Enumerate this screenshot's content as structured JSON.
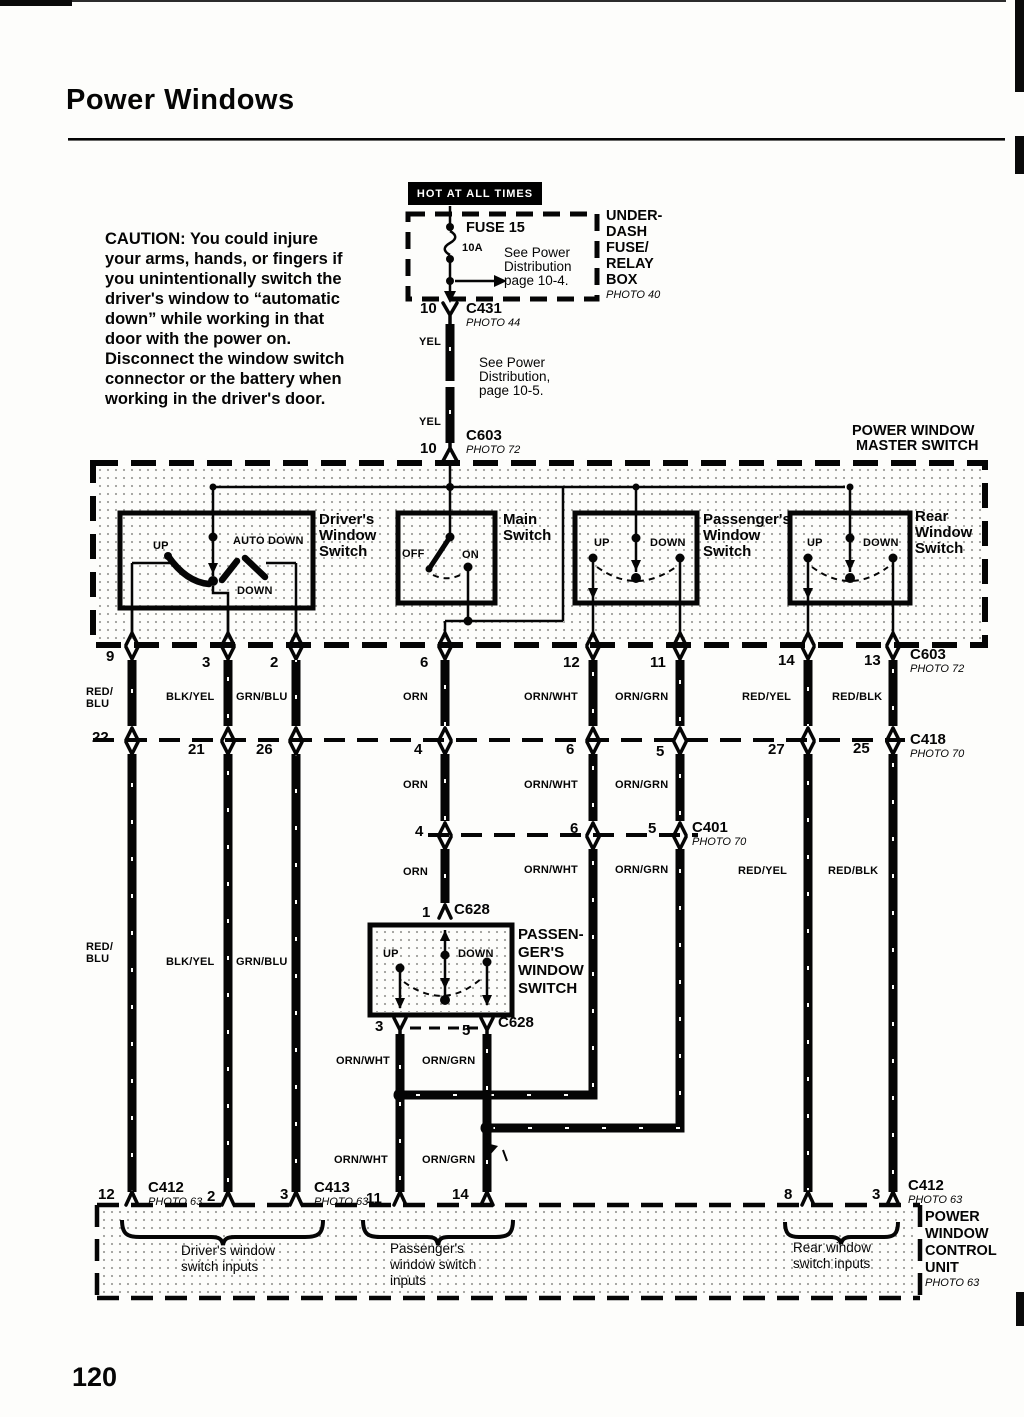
{
  "page": {
    "title": "Power Windows",
    "number": "120"
  },
  "caution": {
    "lines": [
      "CAUTION: You could injure",
      "your arms, hands, or fingers if",
      "you unintentionally switch the",
      "driver's window to “automatic",
      "down” while working in that",
      "door with the power on.",
      "Disconnect the window switch",
      "connector or the battery when",
      "working in the driver's door."
    ]
  },
  "fusebox": {
    "hot": "HOT AT ALL TIMES",
    "fuse": "FUSE 15",
    "amps": "10A",
    "note": [
      "See Power",
      "Distribution",
      "page 10-4."
    ],
    "box_name": [
      "UNDER-",
      "DASH",
      "FUSE/",
      "RELAY",
      "BOX"
    ],
    "photo": "PHOTO 40"
  },
  "feed": {
    "c431_pin": "10",
    "c431": "C431",
    "c431_photo": "PHOTO 44",
    "yel1": "YEL",
    "note": [
      "See Power",
      "Distribution,",
      "page 10-5."
    ],
    "yel2": "YEL",
    "c603_pin": "10",
    "c603": "C603",
    "c603_photo": "PHOTO 72"
  },
  "master": {
    "title": [
      "POWER WINDOW",
      "MASTER SWITCH"
    ],
    "driver": {
      "name": [
        "Driver's",
        "Window",
        "Switch"
      ],
      "up": "UP",
      "auto_down": "AUTO DOWN",
      "down": "DOWN"
    },
    "main": {
      "name": [
        "Main",
        "Switch"
      ],
      "off": "OFF",
      "on": "ON"
    },
    "passenger": {
      "name": [
        "Passenger's",
        "Window",
        "Switch"
      ],
      "up": "UP",
      "down": "DOWN"
    },
    "rear": {
      "name": [
        "Rear",
        "Window",
        "Switch"
      ],
      "up": "UP",
      "down": "DOWN"
    }
  },
  "c603_row": {
    "name": "C603",
    "photo": "PHOTO 72",
    "pins": [
      "9",
      "3",
      "2",
      "6",
      "12",
      "11",
      "14",
      "13"
    ],
    "colors": [
      "RED/\nBLU",
      "BLK/YEL",
      "GRN/BLU",
      "ORN",
      "ORN/WHT",
      "ORN/GRN",
      "RED/YEL",
      "RED/BLK"
    ]
  },
  "c418_row": {
    "name": "C418",
    "photo": "PHOTO 70",
    "pins": [
      "22",
      "21",
      "26",
      "4",
      "6",
      "5",
      "27",
      "25"
    ]
  },
  "mid_colors": [
    "ORN",
    "ORN/WHT",
    "ORN/GRN"
  ],
  "c401_row": {
    "name": "C401",
    "photo": "PHOTO 70",
    "pins": [
      "4",
      "6",
      "5"
    ]
  },
  "lower_colors": [
    "ORN",
    "ORN/WHT",
    "ORN/GRN",
    "RED/YEL",
    "RED/BLK"
  ],
  "left_colors": [
    "RED/\nBLU",
    "BLK/YEL",
    "GRN/BLU"
  ],
  "c628": {
    "top_pin": "1",
    "top_name": "C628",
    "up": "UP",
    "down": "DOWN",
    "name_lines": [
      "PASSEN-",
      "GER'S",
      "WINDOW",
      "SWITCH"
    ],
    "bot_pins": [
      "3",
      "5"
    ],
    "bot_name": "C628",
    "wires1": [
      "ORN/WHT",
      "ORN/GRN"
    ],
    "wires2": [
      "ORN/WHT",
      "ORN/GRN"
    ]
  },
  "bottom_row": {
    "c412l": {
      "pin": "12",
      "name": "C412",
      "photo": "PHOTO 63"
    },
    "pin2": "2",
    "c413": {
      "pin": "3",
      "name": "C413",
      "photo": "PHOTO 63"
    },
    "pin11": "11",
    "pin14": "14",
    "pin8": "8",
    "c412r": {
      "pin": "3",
      "name": "C412",
      "photo": "PHOTO 63"
    }
  },
  "control_unit": {
    "name": [
      "POWER",
      "WINDOW",
      "CONTROL",
      "UNIT"
    ],
    "photo": "PHOTO 63",
    "groups": [
      {
        "lines": [
          "Driver's window",
          "switch inputs"
        ]
      },
      {
        "lines": [
          "Passenger's",
          "window switch",
          "inputs"
        ]
      },
      {
        "lines": [
          "Rear window",
          "switch inputs"
        ]
      }
    ]
  }
}
